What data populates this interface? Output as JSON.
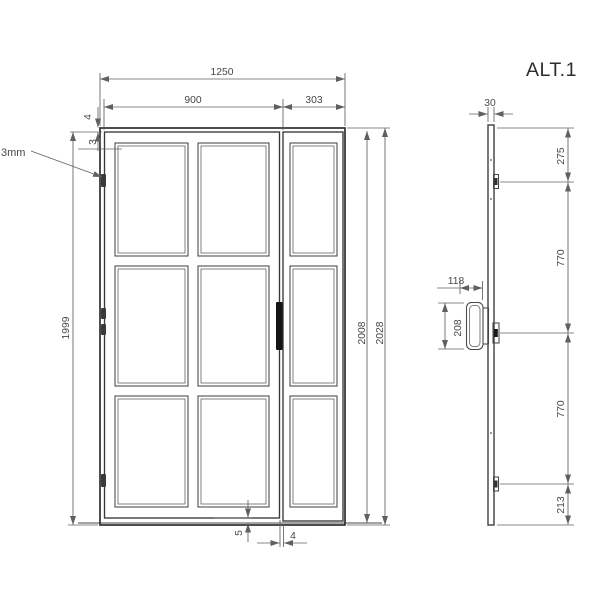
{
  "title_label": "ALT.1",
  "colors": {
    "background": "#ffffff",
    "frame_line": "#2f2f2f",
    "dimension_line": "#606060",
    "text": "#474747",
    "handle_fill": "#141414"
  },
  "front_view": {
    "description": "front elevation of glazed door with sidelight, 3x3 pane grid",
    "dimensions": {
      "overall_width": "1250",
      "door_width": "900",
      "sidelight_width": "303",
      "frame_top_gap": "4",
      "glazing_offset": "3",
      "leader_note": "3mm",
      "door_height": "1999",
      "inner_height": "2008",
      "overall_height": "2028",
      "bottom_clearance": "5",
      "leaf_gap": "4"
    }
  },
  "side_view": {
    "description": "side profile with hinge and handle positions",
    "dimensions": {
      "profile_depth": "30",
      "top_to_hinge": "275",
      "upper_hinge_spacing": "770",
      "lower_hinge_spacing": "770",
      "hinge_to_bottom": "213",
      "handle_projection": "118",
      "handle_length": "208"
    }
  }
}
